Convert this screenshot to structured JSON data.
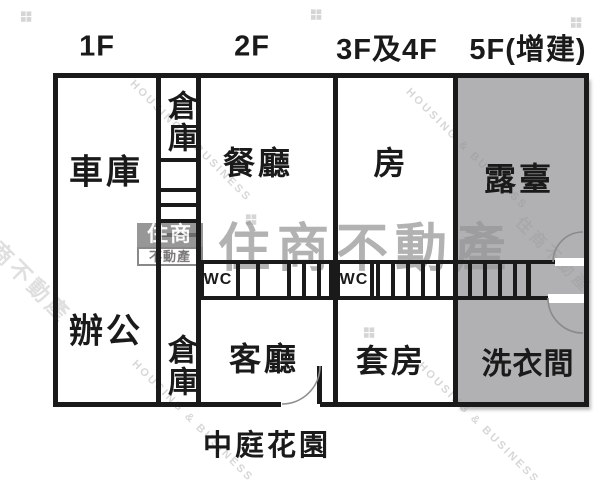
{
  "floors": {
    "f1": "1F",
    "f2": "2F",
    "f3": "3F及4F",
    "f5": "5F(增建)"
  },
  "rooms": {
    "garage": "車庫",
    "storage_top": "倉庫",
    "dining": "餐廳",
    "bedroom": "房",
    "terrace": "露臺",
    "office": "辦公",
    "storage_bottom": "倉庫",
    "living": "客廳",
    "suite": "套房",
    "laundry": "洗衣間",
    "wc_left": "WC",
    "wc_right": "WC"
  },
  "outside": {
    "garden": "中庭花園"
  },
  "watermark": {
    "brand": "住商不動產",
    "logo_top": "住商",
    "logo_bottom": "不動產",
    "diagonal_en": "HOUSING & BUSINESS",
    "diamond_icon": "❖"
  },
  "colors": {
    "wall": "#1a1a1a",
    "terrace_fill": "#b1b1b3",
    "watermark_gray": "#b5b3b4"
  }
}
